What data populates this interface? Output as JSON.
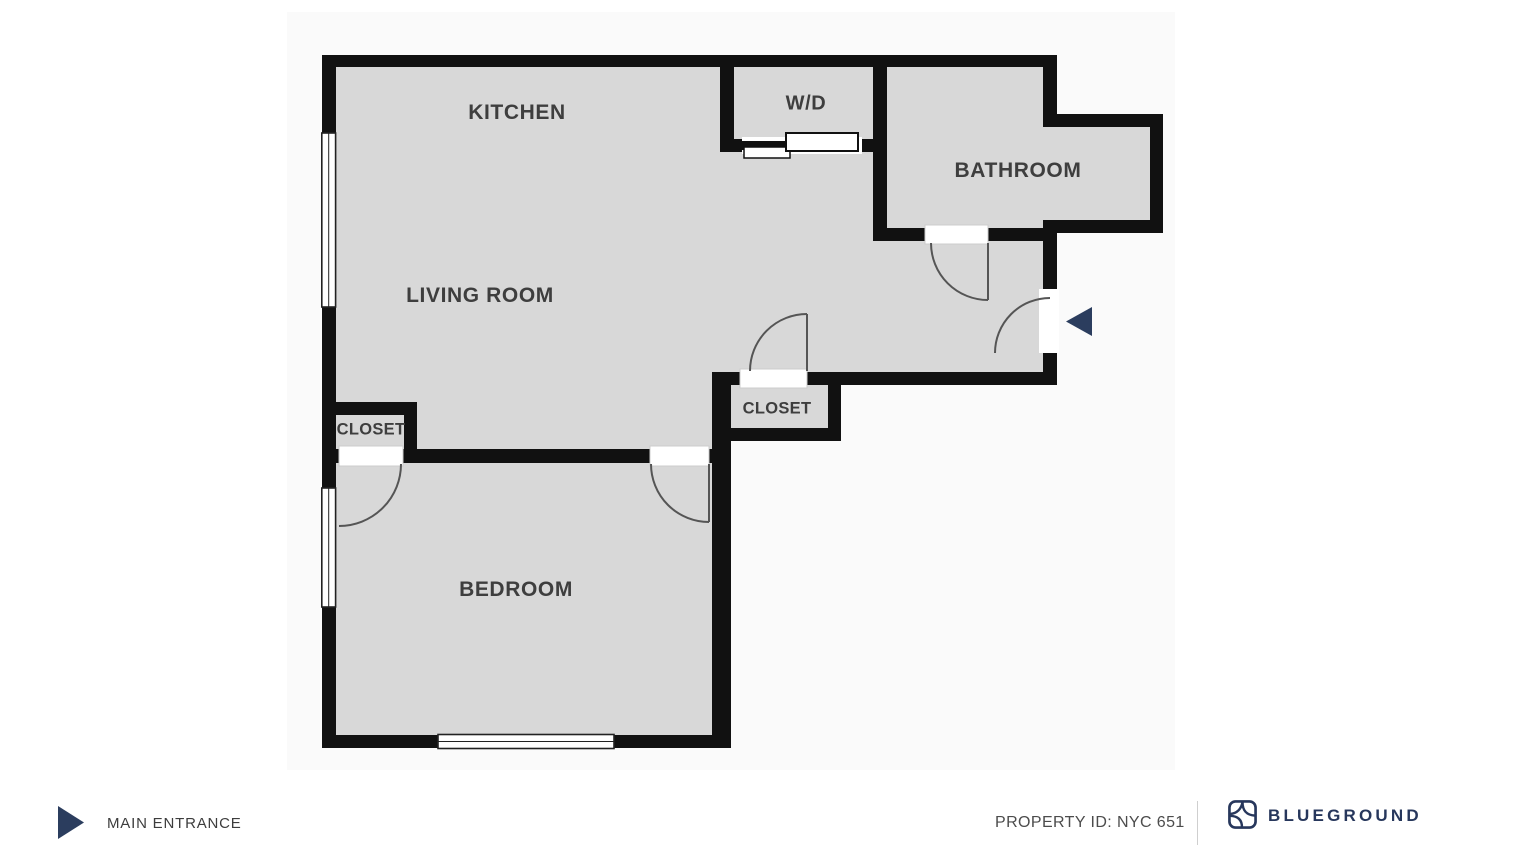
{
  "floorplan": {
    "rooms": [
      {
        "id": "kitchen",
        "label": "KITCHEN"
      },
      {
        "id": "washer-dryer",
        "label": "W/D"
      },
      {
        "id": "bathroom",
        "label": "BATHROOM"
      },
      {
        "id": "living-room",
        "label": "LIVING ROOM"
      },
      {
        "id": "closet-living",
        "label": "CLOSET"
      },
      {
        "id": "closet-hall",
        "label": "CLOSET"
      },
      {
        "id": "bedroom",
        "label": "BEDROOM"
      }
    ],
    "colors": {
      "wall": "#111111",
      "floor_fill": "#d8d8d8",
      "label_text": "#3e3e3e",
      "door_arc": "#555555",
      "entrance_arrow": "#2b3d5e"
    },
    "icons": {
      "entrance_arrow": "left-triangle-arrow",
      "window": "double-line-window",
      "sliding_door": "bypass-sliding-door"
    }
  },
  "legend": {
    "entrance_label": "MAIN ENTRANCE",
    "entrance_icon": "right-triangle-arrow"
  },
  "footer": {
    "property_id": "PROPERTY ID: NYC 651",
    "brand": {
      "name": "BLUEGROUND",
      "logo_icon": "blueground-logo",
      "color": "#27375c"
    }
  }
}
